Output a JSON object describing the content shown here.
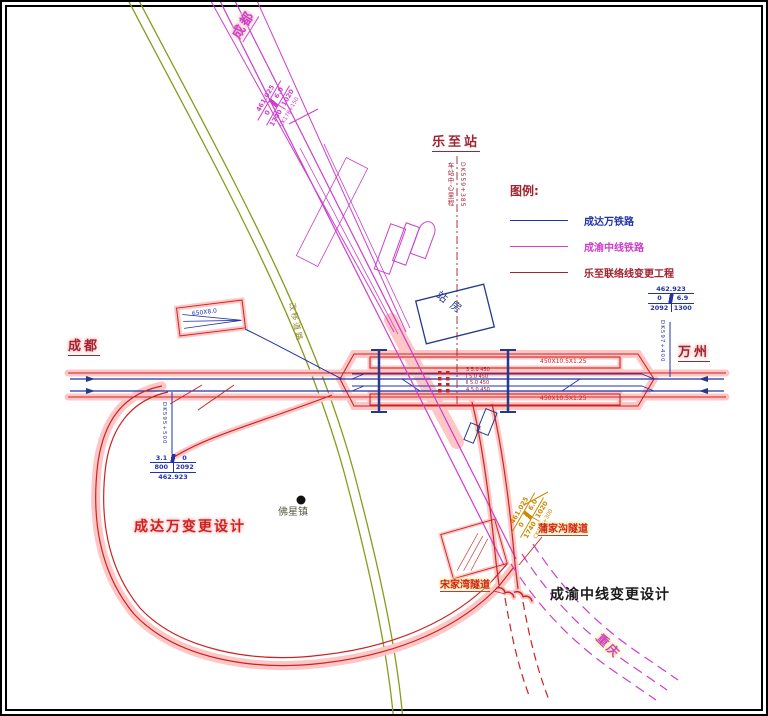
{
  "colors": {
    "cdw_railway_blue": "#2233aa",
    "cyzx_railway_magenta": "#cc3fcc",
    "change_project_darkred": "#a02330",
    "change_highlight_red": "#cc2222",
    "halo_pink": "#ffc2c2",
    "halo_yellow": "#ffe98a",
    "road_olive": "#8a9a1e",
    "marker_orange": "#cc8800",
    "navy_structures": "#223a8c"
  },
  "legend": {
    "title": "图例:",
    "items": [
      {
        "label": "成达万铁路",
        "color": "#2233aa"
      },
      {
        "label": "成渝中线铁路",
        "color": "#cc3fcc"
      },
      {
        "label": "乐至联络线变更工程",
        "color": "#a02330"
      }
    ]
  },
  "labels": {
    "chengdu_top": "成都",
    "chengdu_left": "成都",
    "wanzhou": "万州",
    "chongqing": "重庆",
    "lezhi_station": "乐至站",
    "station_center_caption": "车站中心里程",
    "station_center_mileage": "DK559+385",
    "station_building": "站房",
    "cdw_change_design": "成达万变更设计",
    "cyzx_change_design": "成渝中线变更设计",
    "foxing_town": "佛星镇",
    "songjiawan_tunnel": "宋家湾隧道",
    "pujiagou_tunnel": "蒲家沟隧道",
    "road": "改移道路",
    "yard_dim": "650X8.0"
  },
  "markers": {
    "right": {
      "elevation": "462.923",
      "g1": "0",
      "g2": "6.9",
      "l1": "2092",
      "l2": "1300",
      "mileage": "DK597+400"
    },
    "left": {
      "elevation": "462.923",
      "g1": "3.1",
      "g2": "0",
      "l1": "800",
      "l2": "2092",
      "mileage": "DK595+500"
    },
    "top": {
      "elevation": "461.025",
      "g1": "0",
      "g2": "6.0",
      "l1": "1740",
      "l2": "1020",
      "mileage": "CK178+150"
    },
    "orange": {
      "elevation": "461.025",
      "g1": "0",
      "g2": "6.0",
      "l1": "1740",
      "l2": "1020",
      "mileage": "CK181+300"
    }
  },
  "station": {
    "platform_top": "450X10.5X1.25",
    "platform_bottom": "450X10.5X1.25",
    "track_rows": [
      {
        "t": "3 5.0 450"
      },
      {
        "t": "Ⅰ 5.0 450"
      },
      {
        "t": "Ⅱ 5.0 450"
      },
      {
        "t": "4 5.0 450"
      }
    ]
  }
}
